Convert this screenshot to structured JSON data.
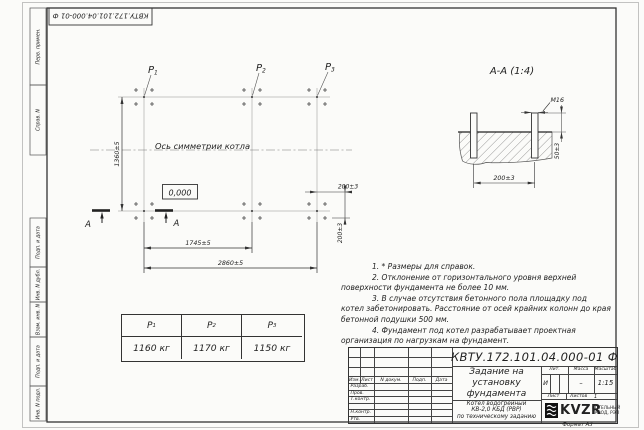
{
  "doc": {
    "number_top": "КВТУ.172.101.04.000-01 Ф",
    "format": "Формат А3"
  },
  "margin_labels": [
    "Перв. примен.",
    "Справ. N",
    "Подп. и дата",
    "Инв. N дубл.",
    "Взам. инв. N",
    "Подп. и дата",
    "Инв. N подл."
  ],
  "plan": {
    "axis_label": "Ось симметрии котла",
    "level_mark": "0,000",
    "section_letter_left": "A",
    "section_letter_right": "A",
    "labels": [
      {
        "base": "P",
        "sub": "1"
      },
      {
        "base": "P",
        "sub": "2"
      },
      {
        "base": "P",
        "sub": "3"
      }
    ],
    "dim_height": "1360±5",
    "dim_span_inner": "1745±5",
    "dim_span_outer": "2860±5",
    "dim_offset_h": "200±3",
    "dim_offset_v": "200±3"
  },
  "section_view": {
    "title": "А-А (1:4)",
    "thread": "М16",
    "dim_protrusion": "50±3",
    "dim_bolt_spacing": "200±3"
  },
  "notes": [
    "1. * Размеры для справок.",
    "2. Отклонение от горизонтального уровня верхней поверхности фундамента не более 10 мм.",
    "3. В случае отсутствия бетонного пола площадку под котел забетонировать. Расстояние от осей крайних колонн до края бетонной подушки 500 мм.",
    "4. Фундамент под котел разрабатывает проектная организация по нагрузкам на фундамент."
  ],
  "load_table": {
    "headers": [
      {
        "base": "P",
        "sub": "1"
      },
      {
        "base": "P",
        "sub": "2"
      },
      {
        "base": "P",
        "sub": "3"
      }
    ],
    "values": [
      "1160 кг",
      "1170 кг",
      "1150 кг"
    ]
  },
  "title_block": {
    "doc_number": "КВТУ.172.101.04.000-01 Ф",
    "title_lines": [
      "Задание на",
      "установку",
      "фундамента"
    ],
    "subtitle_lines": [
      "Котел водогрейный",
      "КВ-2,0 КБД (РВР)",
      "по техническому заданию"
    ],
    "col_headers": [
      "Изм.",
      "Лист",
      "N докум.",
      "Подп.",
      "Дата"
    ],
    "row_labels": [
      "Разраб.",
      "Пров.",
      "Т.контр.",
      "Н.контр.",
      "Утв."
    ],
    "lit_header": "Лит.",
    "mass_header": "Масса",
    "scale_header": "Масштаб",
    "lit_value": "И",
    "mass_value": "–",
    "scale_value": "1:15",
    "sheet_label": "Лист",
    "sheets_label": "Листов",
    "sheets_value": "1",
    "brand": "KVZR",
    "brand_sub1": "КОТЕЛЬНЫЙ",
    "brand_sub2": "ЗАВОД, РЭП"
  }
}
